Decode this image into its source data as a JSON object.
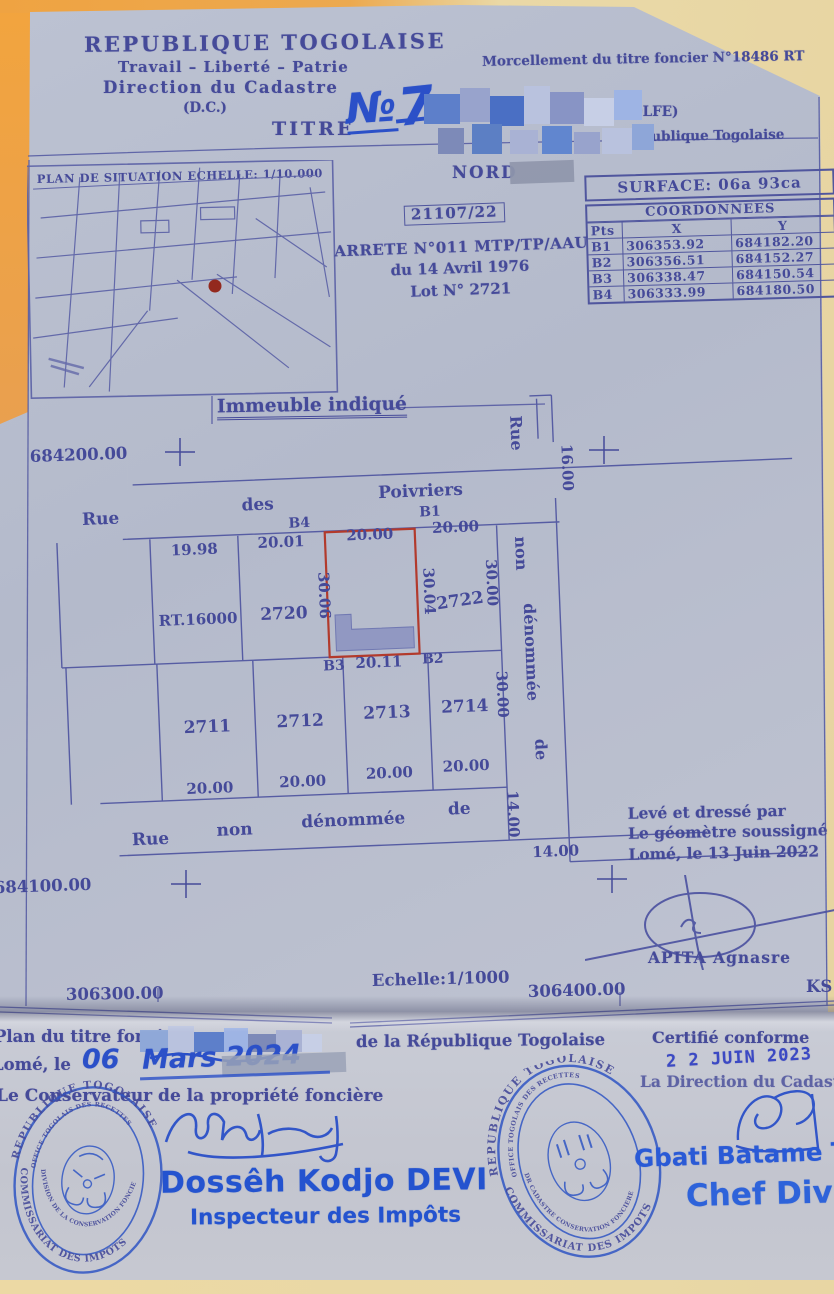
{
  "header": {
    "republic": "REPUBLIQUE TOGOLAISE",
    "motto": "Travail – Liberté – Patrie",
    "direction": "Direction du Cadastre",
    "dc": "(D.C.)",
    "titre_label": "TITRE",
    "titre_no": "№",
    "titre_digit": "7",
    "morcellement": "Morcellement du titre foncier N°18486 RT",
    "golfe": "(GOLFE)",
    "republique_small": "République Togolaise"
  },
  "situation_map": {
    "title": "PLAN DE SITUATION ECHELLE: 1/10.000"
  },
  "plan": {
    "nord": "NORD",
    "surface": "SURFACE: 06a 93ca",
    "dossier": "21107/22",
    "arrete1": "ARRETE N°011 MTP/TP/AAU",
    "arrete2": "du 14 Avril 1976",
    "arrete3": "Lot N° 2721",
    "immeuble": "Immeuble indiqué",
    "street_top": {
      "w1": "Rue",
      "w2": "des",
      "w3": "Poivriers"
    },
    "street_right": {
      "w1": "Rue",
      "w2": "non",
      "w3": "dénommée",
      "w4": "de"
    },
    "street_bottom": {
      "w1": "Rue",
      "w2": "non",
      "w3": "dénommée",
      "w4": "de"
    },
    "points": {
      "b1": "B1",
      "b2": "B2",
      "b3": "B3",
      "b4": "B4"
    },
    "lots": {
      "rt": "RT.16000",
      "l2720": "2720",
      "l2722": "2722",
      "l2711": "2711",
      "l2712": "2712",
      "l2713": "2713",
      "l2714": "2714"
    },
    "dims": {
      "top1": "19.98",
      "top2": "20.01",
      "top3": "20.00",
      "top4": "20.00",
      "red_left": "30.06",
      "red_right": "30.04",
      "right2722": "30.00",
      "red_bottom": "20.11",
      "row2_1": "20.00",
      "row2_2": "20.00",
      "row2_3": "20.00",
      "row2_4": "20.00",
      "right30": "30.00",
      "right14": "14.00",
      "street16": "16.00",
      "bottom14": "14.00"
    },
    "ticks": {
      "nw": "684200.00",
      "sw": "684100.00",
      "s1": "306300.00",
      "s2": "306400.00",
      "echelle": "Echelle:1/1000",
      "ks": "KS"
    }
  },
  "coord_table": {
    "title": "COORDONNEES",
    "headers": [
      "Pts",
      "X",
      "Y"
    ],
    "rows": [
      [
        "B1",
        "306353.92",
        "684182.20"
      ],
      [
        "B2",
        "306356.51",
        "684152.27"
      ],
      [
        "B3",
        "306338.47",
        "684150.54"
      ],
      [
        "B4",
        "306333.99",
        "684180.50"
      ]
    ]
  },
  "surveyor": {
    "line1": "Levé et dressé par",
    "line2": "Le géomètre soussigné",
    "line3": "Lomé, le 13 Juin 2022",
    "name": "APITA Agnasre"
  },
  "footer": {
    "plan_du": "Plan du titre foncier",
    "de_la": "de la République Togolaise",
    "lome_le": "Lomé, le",
    "date_day": "06",
    "date_rest": "Mars 2024",
    "conservateur": "Le Conservateur de la propriété foncière",
    "devi_name": "Dossêh Kodjo DEVI",
    "devi_title": "Inspecteur des Impôts",
    "certifie": "Certifié conforme",
    "date_stamp": "2 2  JUIN  2023",
    "direction": "La Direction du Cadastre",
    "tafamba": "Gbati Batame TAFAMBA -",
    "chef": "Chef Division Cada"
  },
  "stamps": {
    "left": {
      "arc_top": "REPUBLIQUE TOGOLAISE",
      "arc_inner": "OFFICE TOGOLAIS DES RECETTES",
      "arc_mid": "DIVISION DE LA CONSERVATION FONCIERE",
      "arc_bottom": "COMMISSARIAT DES IMPOTS"
    },
    "right": {
      "arc_top": "REPUBLIQUE TOGOLAISE",
      "arc_inner": "OFFICE TOGOLAIS DES RECETTES",
      "arc_mid": "DR CADASTRE CONSERVATION FONCIERE",
      "arc_bottom": "COMMISSARIAT DES IMPOTS"
    }
  },
  "colors": {
    "ink": "#454a99",
    "hand_blue": "#2b50c8",
    "stamp_blue": "#2f55c4",
    "parcel_red": "#b23a2c",
    "paper": "#b8bed0"
  }
}
